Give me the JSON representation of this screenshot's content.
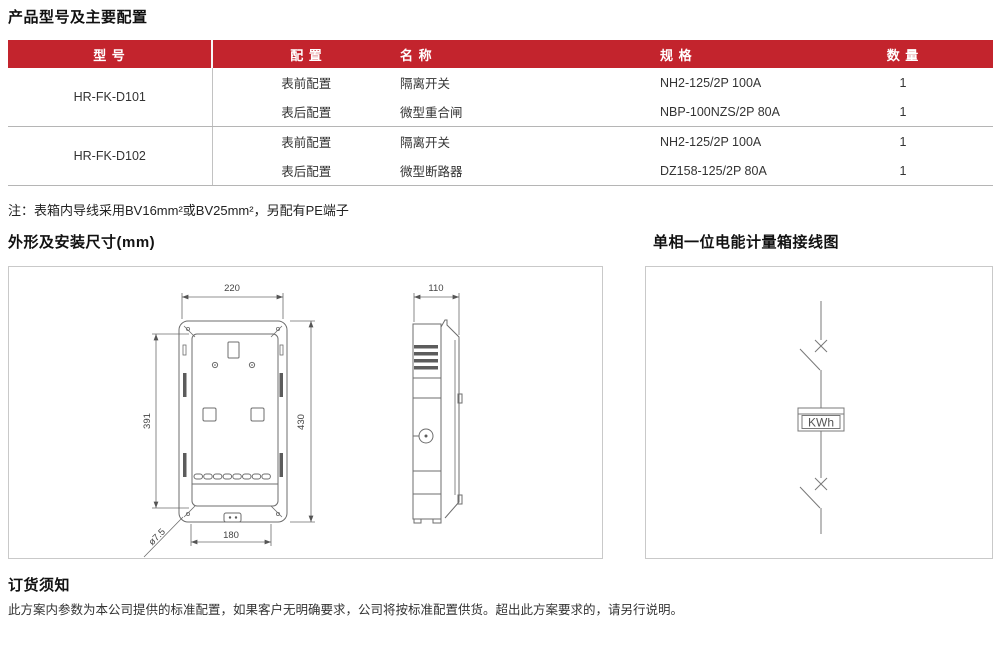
{
  "titles": {
    "products": "产品型号及主要配置",
    "dimensions": "外形及安装尺寸(mm)",
    "wiring": "单相一位电能计量箱接线图",
    "order": "订货须知"
  },
  "note": "注：表箱内导线采用BV16mm²或BV25mm²，另配有PE端子",
  "order_text": "此方案内参数为本公司提供的标准配置，如果客户无明确要求，公司将按标准配置供货。超出此方案要求的，请另行说明。",
  "colors": {
    "header_bg": "#c3242d"
  },
  "table": {
    "headers": [
      "型 号",
      "配 置",
      "名 称",
      "规 格",
      "数 量"
    ],
    "rows": [
      {
        "model": "HR-FK-D101",
        "items": [
          {
            "config": "表前配置",
            "name": "隔离开关",
            "spec": "NH2-125/2P 100A",
            "qty": "1"
          },
          {
            "config": "表后配置",
            "name": "微型重合闸",
            "spec": "NBP-100NZS/2P 80A",
            "qty": "1"
          }
        ]
      },
      {
        "model": "HR-FK-D102",
        "items": [
          {
            "config": "表前配置",
            "name": "隔离开关",
            "spec": "NH2-125/2P 100A",
            "qty": "1"
          },
          {
            "config": "表后配置",
            "name": "微型断路器",
            "spec": "DZ158-125/2P 80A",
            "qty": "1"
          }
        ]
      }
    ]
  },
  "drawing": {
    "front": {
      "width_top": "220",
      "height_left": "391",
      "height_right": "430",
      "width_bottom": "180",
      "hole": "ø7.5"
    },
    "side": {
      "width_top": "110"
    },
    "meter_label": "KWh"
  }
}
